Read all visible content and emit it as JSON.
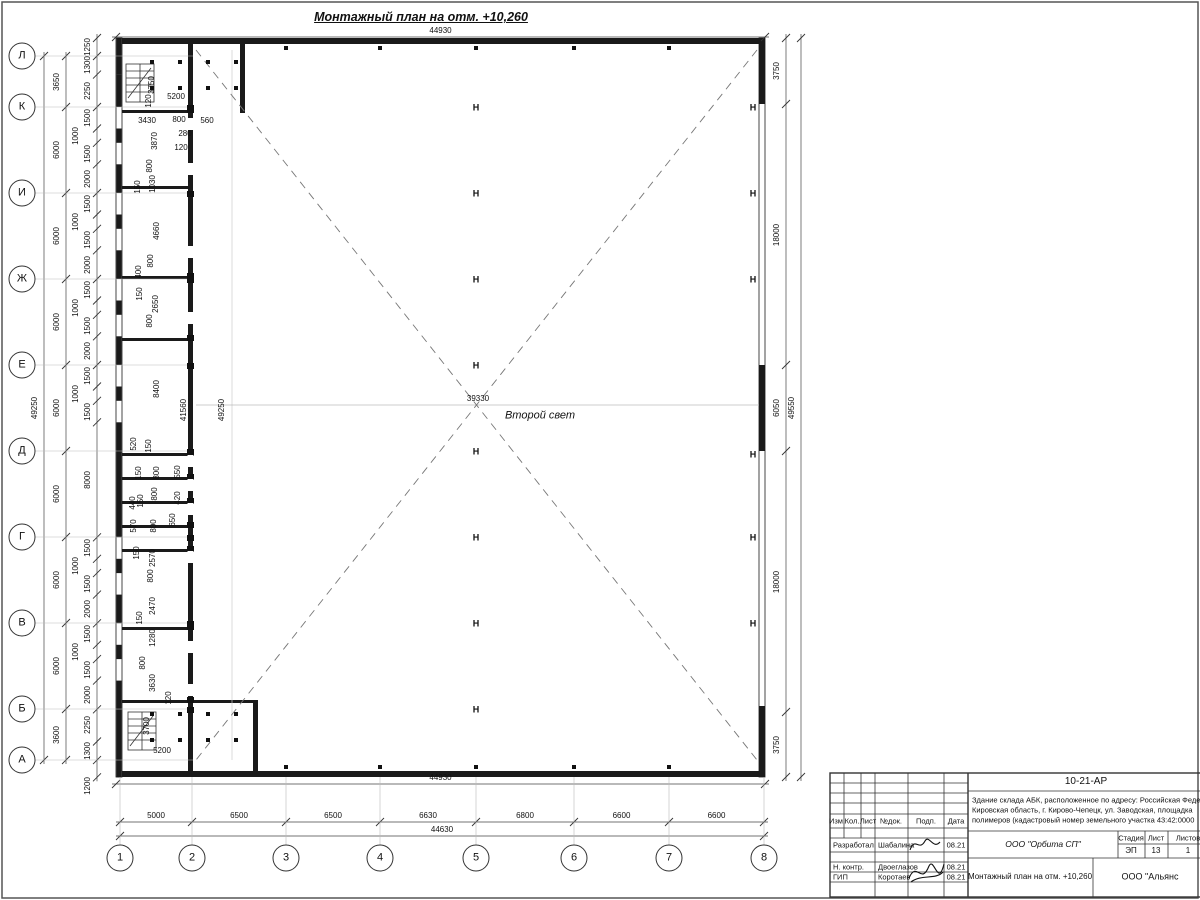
{
  "title": "Монтажный план на отм. +10,260",
  "hall_label": "Второй свет",
  "axes": {
    "left": {
      "labels": [
        "Л",
        "К",
        "И",
        "Ж",
        "Е",
        "Д",
        "Г",
        "В",
        "Б",
        "А"
      ],
      "y": [
        56,
        107,
        193,
        279,
        365,
        451,
        537,
        623,
        709,
        760
      ]
    },
    "bottom": {
      "labels": [
        "1",
        "2",
        "3",
        "4",
        "5",
        "6",
        "7",
        "8"
      ],
      "x": [
        120,
        192,
        286,
        380,
        476,
        574,
        669,
        764
      ]
    }
  },
  "chains": [
    {
      "name": "left-axis-dims",
      "o": "v",
      "line": 66,
      "b": [
        56,
        107,
        193,
        279,
        365,
        451,
        537,
        623,
        709,
        760
      ],
      "labels": [
        "3650",
        "6000",
        "6000",
        "6000",
        "6000",
        "6000",
        "6000",
        "6000",
        "3600"
      ]
    },
    {
      "name": "left-overall",
      "o": "v",
      "line": 44,
      "b": [
        56,
        760
      ],
      "labels": [
        "49250"
      ]
    },
    {
      "name": "left-detail",
      "o": "v",
      "line": 97,
      "b": [
        38,
        56,
        74.6,
        107,
        128.5,
        142.8,
        164.3,
        193,
        214.5,
        228.8,
        250.3,
        279,
        300.5,
        314.8,
        336.3,
        365,
        386.5,
        400.8,
        422.3,
        537.3,
        558.8,
        573.1,
        594.6,
        623.3,
        644.8,
        659.1,
        680.6,
        709.3,
        741.5,
        760.1,
        777.3
      ],
      "labels": [
        "1250",
        "1300",
        "2250",
        "1500",
        "1000",
        "1500",
        "2000",
        "1500",
        "1000",
        "1500",
        "2000",
        "1500",
        "1000",
        "1500",
        "2000",
        "1500",
        "1000",
        "1500",
        "8000",
        "1500",
        "1000",
        "1500",
        "2000",
        "1500",
        "1000",
        "1500",
        "2000",
        "2250",
        "1300",
        ""
      ]
    },
    {
      "name": "right-detail",
      "o": "v",
      "line": 786,
      "b": [
        38,
        104,
        365,
        451,
        712,
        777
      ],
      "labels": [
        "3750",
        "18000",
        "6050",
        "18000",
        "3750"
      ]
    },
    {
      "name": "right-overall",
      "o": "v",
      "line": 801,
      "b": [
        38,
        777
      ],
      "labels": [
        "49550"
      ]
    },
    {
      "name": "top-overall",
      "o": "h",
      "line": 37,
      "b": [
        116,
        765
      ],
      "labels": [
        "44930"
      ]
    },
    {
      "name": "bottom-overall-44930",
      "o": "h",
      "line": 784,
      "b": [
        116,
        765
      ],
      "labels": [
        "44930"
      ]
    },
    {
      "name": "bottom-axis-dims",
      "o": "h",
      "line": 822,
      "b": [
        120,
        192,
        286,
        380,
        476,
        574,
        669,
        764
      ],
      "labels": [
        "5000",
        "6500",
        "6500",
        "6630",
        "6800",
        "6600",
        "6600"
      ]
    },
    {
      "name": "bottom-overall-44630",
      "o": "h",
      "line": 836,
      "b": [
        120,
        764
      ],
      "labels": [
        "44630"
      ]
    }
  ],
  "dim_labels": [
    {
      "t": "3750",
      "x": 152,
      "y": 85,
      "r": 1
    },
    {
      "t": "5200",
      "x": 176,
      "y": 97,
      "r": 0
    },
    {
      "t": "120",
      "x": 149,
      "y": 101,
      "r": 1
    },
    {
      "t": "3430",
      "x": 147,
      "y": 121,
      "r": 0
    },
    {
      "t": "800",
      "x": 179,
      "y": 120,
      "r": 0
    },
    {
      "t": "560",
      "x": 207,
      "y": 121,
      "r": 0
    },
    {
      "t": "280",
      "x": 185,
      "y": 134,
      "r": 0
    },
    {
      "t": "120",
      "x": 181,
      "y": 148,
      "r": 0
    },
    {
      "t": "3870",
      "x": 155,
      "y": 141,
      "r": 1
    },
    {
      "t": "800",
      "x": 150,
      "y": 166,
      "r": 1
    },
    {
      "t": "150",
      "x": 138,
      "y": 187,
      "r": 1
    },
    {
      "t": "1030",
      "x": 153,
      "y": 184,
      "r": 1
    },
    {
      "t": "4660",
      "x": 157,
      "y": 231,
      "r": 1
    },
    {
      "t": "800",
      "x": 151,
      "y": 261,
      "r": 1
    },
    {
      "t": "400",
      "x": 139,
      "y": 272,
      "r": 1
    },
    {
      "t": "150",
      "x": 140,
      "y": 294,
      "r": 1
    },
    {
      "t": "2650",
      "x": 156,
      "y": 304,
      "r": 1
    },
    {
      "t": "800",
      "x": 150,
      "y": 321,
      "r": 1
    },
    {
      "t": "8400",
      "x": 157,
      "y": 389,
      "r": 1
    },
    {
      "t": "41560",
      "x": 184,
      "y": 410,
      "r": 1
    },
    {
      "t": "49250",
      "x": 222,
      "y": 410,
      "r": 1
    },
    {
      "t": "520",
      "x": 134,
      "y": 444,
      "r": 1
    },
    {
      "t": "150",
      "x": 149,
      "y": 446,
      "r": 1
    },
    {
      "t": "150",
      "x": 139,
      "y": 473,
      "r": 1
    },
    {
      "t": "800",
      "x": 157,
      "y": 473,
      "r": 1
    },
    {
      "t": "550",
      "x": 178,
      "y": 472,
      "r": 1
    },
    {
      "t": "440",
      "x": 133,
      "y": 503,
      "r": 1
    },
    {
      "t": "150",
      "x": 141,
      "y": 501,
      "r": 1
    },
    {
      "t": "800",
      "x": 155,
      "y": 494,
      "r": 1
    },
    {
      "t": "420",
      "x": 178,
      "y": 498,
      "r": 1
    },
    {
      "t": "650",
      "x": 173,
      "y": 520,
      "r": 1
    },
    {
      "t": "570",
      "x": 134,
      "y": 526,
      "r": 1
    },
    {
      "t": "800",
      "x": 154,
      "y": 526,
      "r": 1
    },
    {
      "t": "150",
      "x": 137,
      "y": 553,
      "r": 1
    },
    {
      "t": "2570",
      "x": 153,
      "y": 558,
      "r": 1
    },
    {
      "t": "800",
      "x": 151,
      "y": 576,
      "r": 1
    },
    {
      "t": "2470",
      "x": 153,
      "y": 606,
      "r": 1
    },
    {
      "t": "150",
      "x": 140,
      "y": 618,
      "r": 1
    },
    {
      "t": "1280",
      "x": 153,
      "y": 638,
      "r": 1
    },
    {
      "t": "800",
      "x": 143,
      "y": 663,
      "r": 1
    },
    {
      "t": "3630",
      "x": 153,
      "y": 683,
      "r": 1
    },
    {
      "t": "120",
      "x": 169,
      "y": 698,
      "r": 1
    },
    {
      "t": "3700",
      "x": 147,
      "y": 726,
      "r": 1
    },
    {
      "t": "5200",
      "x": 162,
      "y": 751,
      "r": 0
    },
    {
      "t": "1200",
      "x": 88,
      "y": 786,
      "r": 1
    },
    {
      "t": "39330",
      "x": 478,
      "y": 399,
      "r": 0
    }
  ],
  "columns": {
    "glyph": "Н",
    "center_x": 476,
    "center_ys": [
      108,
      194,
      280,
      366,
      452,
      538,
      624,
      710
    ],
    "right_x": 753,
    "right_ys": [
      108,
      194,
      280,
      455,
      538,
      624
    ]
  },
  "wall_ticks": {
    "xs": [
      286,
      380,
      476,
      574,
      669
    ],
    "top_y": 46,
    "bottom_y": 765
  },
  "room_dots": {
    "xs": [
      152,
      180,
      208,
      236
    ],
    "top_ys": [
      62,
      88
    ],
    "bottom_ys": [
      714,
      740
    ]
  },
  "inner_columns_ys": [
    108,
    194,
    280,
    366,
    452,
    538,
    624,
    710,
    110,
    276,
    338,
    453,
    477,
    501,
    525,
    549,
    627,
    700
  ],
  "door_gaps_y": [
    118,
    163,
    246,
    312,
    455,
    479,
    503,
    551,
    641,
    684
  ],
  "titleblock": {
    "code": "10-21-АР",
    "desc_lines": [
      "Здание склада АБК, расположенное по адресу: Российская Феде",
      "Кировская область, г. Кирово-Чепецк, ул. Заводская, площадка",
      "полимеров (кадастровый номер земельного участка 43:42:0000"
    ],
    "header": [
      "Изм.",
      "Кол.",
      "Лист",
      "№док.",
      "Подп.",
      "Дата"
    ],
    "rows": [
      {
        "role": "Разработал",
        "name": "Шабалина",
        "date": "08.21"
      },
      {
        "role": "Н. контр.",
        "name": "Двоеглазов",
        "date": "08.21"
      },
      {
        "role": "ГИП",
        "name": "Коротаев",
        "date": "08.21"
      }
    ],
    "org": "ООО \"Орбита СП\"",
    "stage_header": [
      "Стадия",
      "Лист",
      "Листов"
    ],
    "stage_values": [
      "ЭП",
      "13",
      "1"
    ],
    "doc_title": "Монтажный план на отм. +10,260",
    "company": "ООО \"Альянс"
  }
}
